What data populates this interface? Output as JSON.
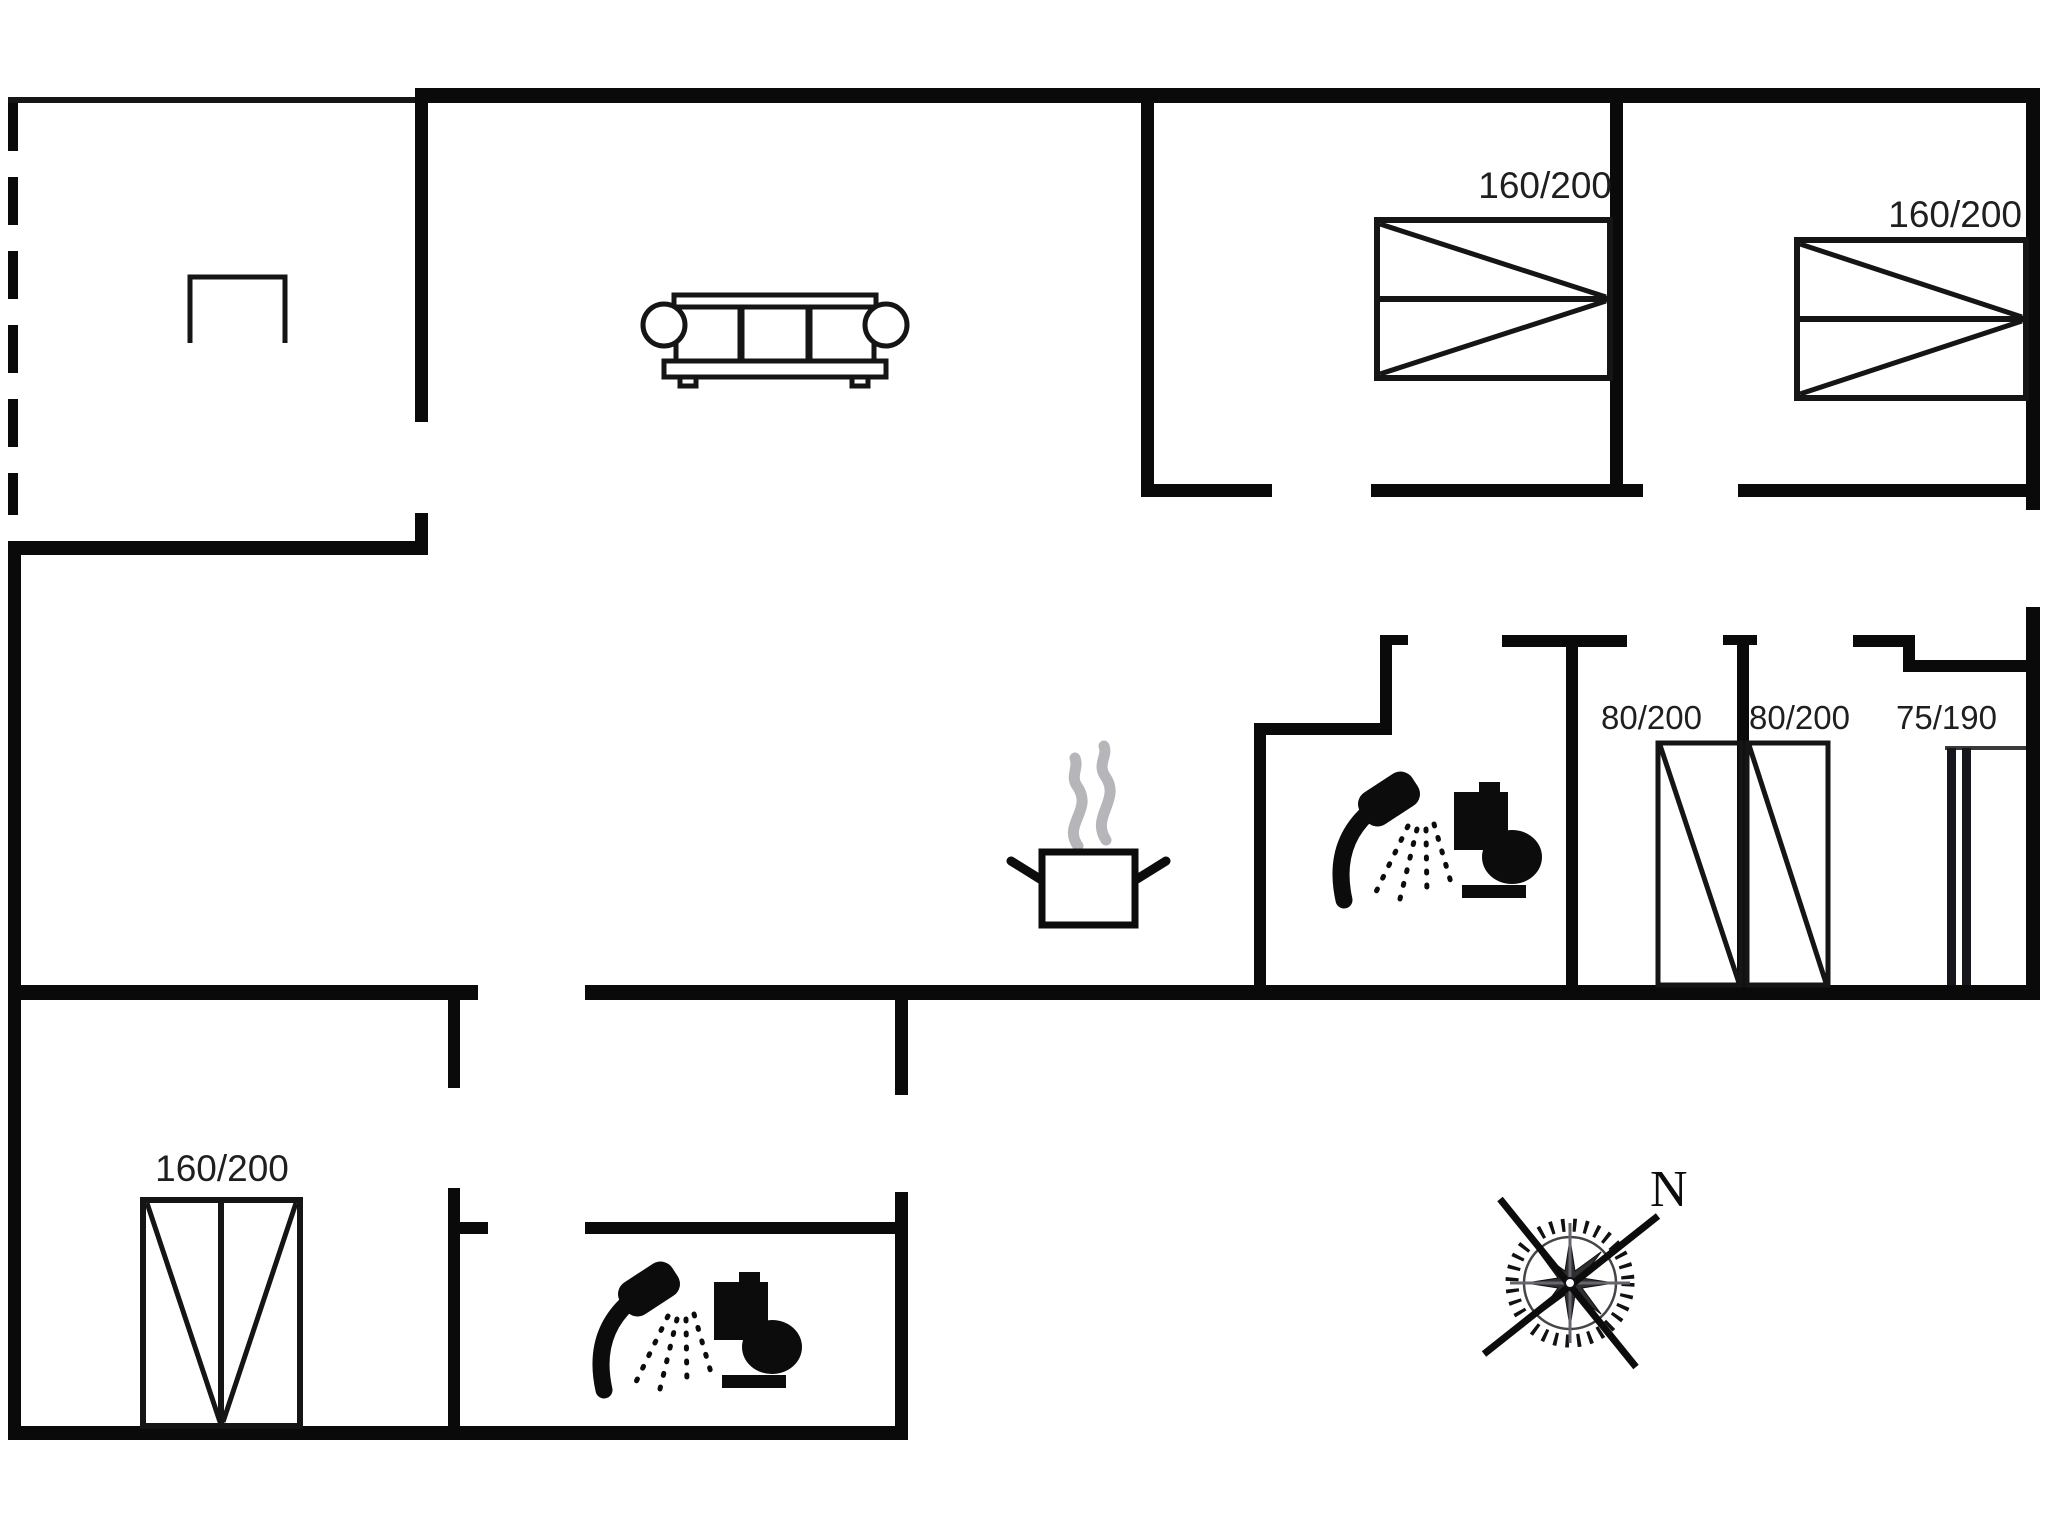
{
  "floor_plan": {
    "type": "vacation-house-floor-plan",
    "beds": [
      {
        "id": "bed-1",
        "size_label": "160/200"
      },
      {
        "id": "bed-2",
        "size_label": "160/200"
      },
      {
        "id": "bed-3",
        "size_label": "160/200"
      }
    ],
    "closets": [
      {
        "id": "closet-1",
        "size_label": "80/200"
      },
      {
        "id": "closet-2",
        "size_label": "80/200"
      },
      {
        "id": "closet-3",
        "size_label": "75/190"
      }
    ],
    "compass": {
      "north_label": "N"
    },
    "icons": [
      "sofa-icon",
      "cooking-pot-icon",
      "steam-icon",
      "shower-icon",
      "toilet-icon",
      "double-bed-icon",
      "wardrobe-icon",
      "tall-cupboard-icon",
      "compass-rose-icon",
      "terrace-furniture-icon"
    ],
    "colors": {
      "wall": "#0a0a0a",
      "furniture_stroke": "#151515",
      "label": "#1f1f1f",
      "steam": "#b5b5ba",
      "background": "#ffffff"
    }
  }
}
